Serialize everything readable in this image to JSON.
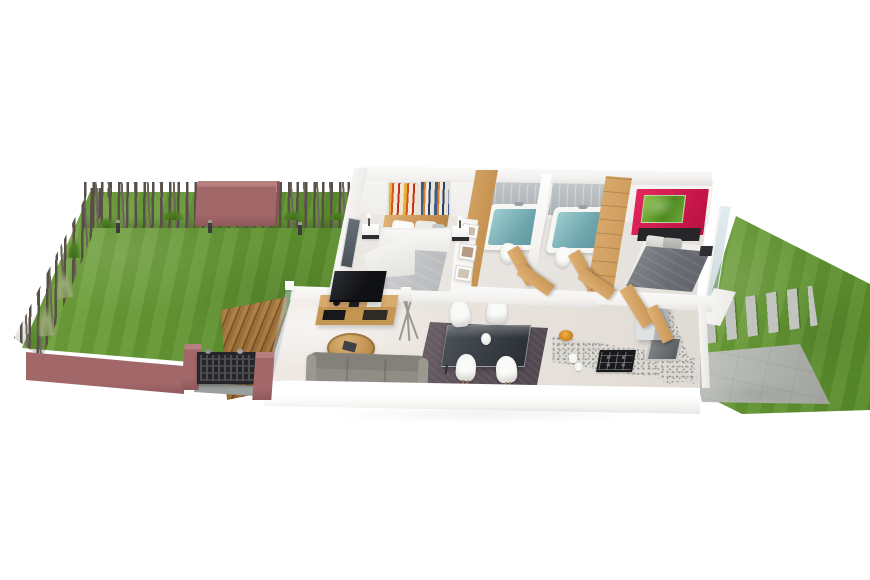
{
  "meta": {
    "kind": "3d-floor-plan-render",
    "view": "aerial-isometric",
    "canvas": {
      "width": 870,
      "height": 580
    },
    "background": "#ffffff"
  },
  "theme": {
    "bg": "#ffffff",
    "grass-a": "#74a43f",
    "grass-b": "#649633",
    "grass-c": "#568928",
    "fence-a": "#584f46",
    "fence-b": "#6e665c",
    "pink": "#a16769",
    "pink-light": "#b5807f",
    "pink-dark": "#91585c",
    "deck-a": "#ad7a38",
    "deck-b": "#6f4a1e",
    "wood-a": "#e0b277",
    "wood-b": "#c89554",
    "floor-a": "#ece8e4",
    "floor-b": "#e0dad4",
    "tile-a": "#ccd0d3",
    "tile-b": "#a6abaf",
    "water-a": "#9ccdd0",
    "water-b": "#5e97a0",
    "duvet1-a": "#d6d7d8",
    "duvet1-b": "#b3b5b8",
    "duvet2-a": "#898c91",
    "duvet2-b": "#5c6066",
    "red-a": "#e3285e",
    "red-b": "#b90f3f",
    "art-green-a": "#8cc24a",
    "art-green-b": "#4e8a20",
    "rug-a": "#6e6168",
    "rug-b": "#4e454d",
    "tv": "#101114",
    "counter": "#dcdad5",
    "sofa": "#8f8d85",
    "concrete-a": "#c6c9c3",
    "concrete-b": "#9fa29c",
    "paver": "#c2c5bf"
  },
  "scene": {
    "left_garden": {
      "label": "rear garden with lawn, stick fence, pink feature wall, bollard lights, timber deck and built-in barbecue",
      "lawn": "grass lawn",
      "fence": "rustic timber stick fence (top and left boundaries)",
      "feature_wall": "pink rendered privacy wall",
      "bollard_lights_count": 3,
      "grass_tufts_count": 7,
      "deck": "timber deck",
      "bbq": "built-in barbecue in pink boundary wall"
    },
    "house": {
      "label": "single-storey house, open-top 3D floor plan",
      "rooms": {
        "bedroom1": {
          "label": "Bedroom 1",
          "items": [
            "double bed",
            "timber headboard",
            "2 abstract wall canvases",
            "2 nightstands",
            "2 table lamps",
            "window",
            "built-in wardrobe",
            "3 photo frames"
          ]
        },
        "bathroom1": {
          "label": "Bathroom 1",
          "items": [
            "bathtub",
            "grey wall tiles",
            "toilet",
            "timber door"
          ]
        },
        "bathroom2": {
          "label": "Bathroom 2",
          "items": [
            "bathtub",
            "grey wall tiles",
            "toilet",
            "timber door"
          ]
        },
        "bedroom2": {
          "label": "Bedroom 2",
          "items": [
            "double bed",
            "black headboard",
            "red feature panel",
            "green canvas artwork",
            "timber wardrobe",
            "floating nightstand",
            "glass slider to side garden"
          ]
        },
        "living": {
          "label": "Living room",
          "items": [
            "flat-screen TV",
            "timber TV unit",
            "tripod floor lamp",
            "round timber coffee table",
            "grey sofa",
            "glass wall to deck"
          ]
        },
        "dining": {
          "label": "Dining area",
          "items": [
            "dark area rug",
            "glass dining table",
            "4 white chairs",
            "white vase"
          ]
        },
        "kitchen": {
          "label": "Kitchen",
          "items": [
            "L-shaped granite benchtop",
            "4-burner gas cooktop",
            "sink",
            "refrigerator",
            "fruit bowl",
            "2 canisters"
          ]
        }
      }
    },
    "right_garden": {
      "label": "side garden with lawn, stepping pavers and concrete patio",
      "lawn": "grass lawn",
      "stepping_pavers_count": 11,
      "patio": "concrete patio",
      "grass_tufts_count": 2
    }
  }
}
